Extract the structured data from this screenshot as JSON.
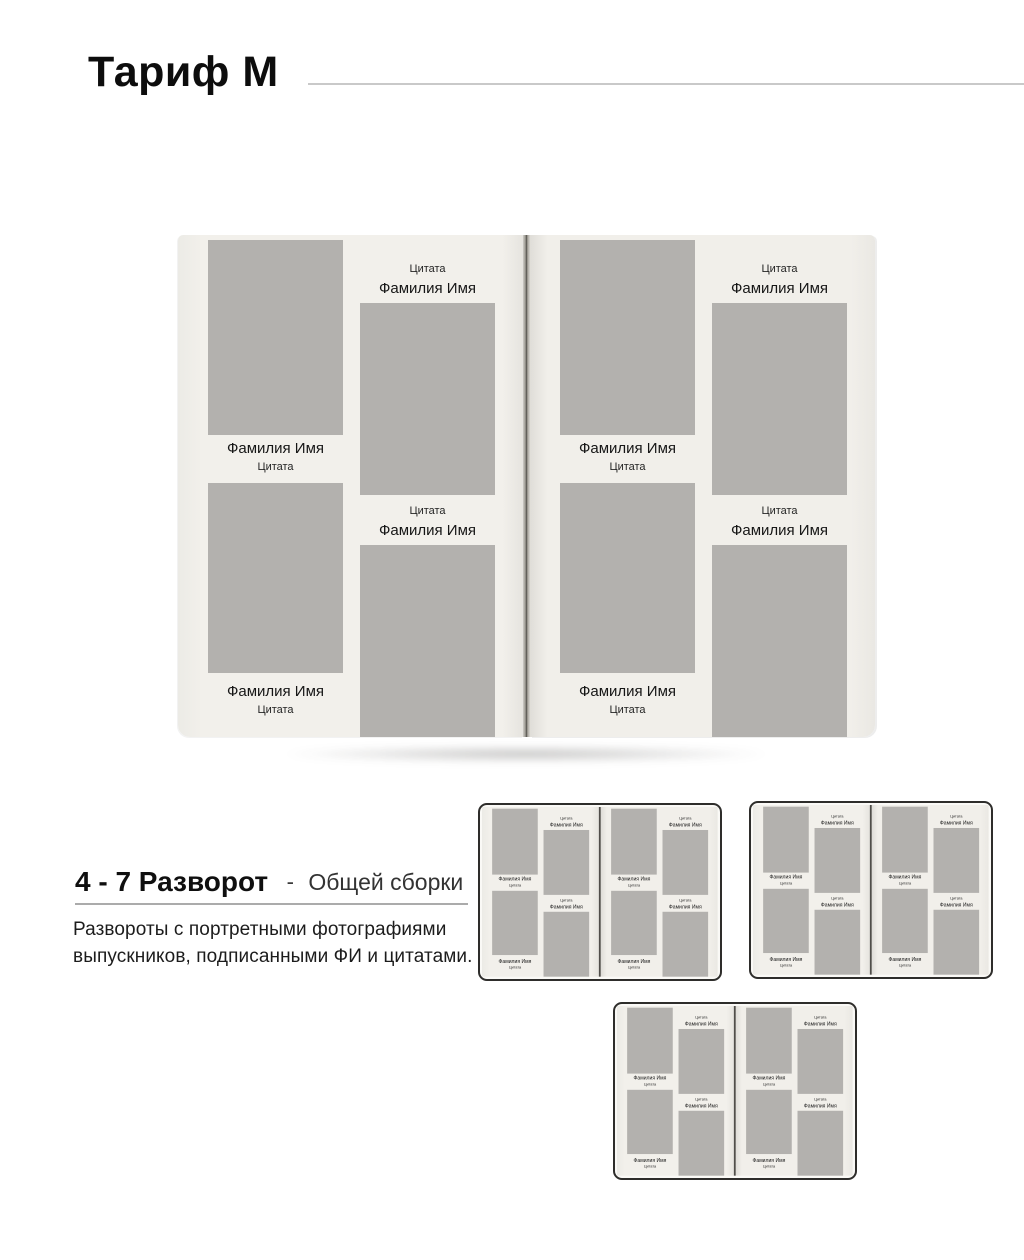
{
  "header": {
    "title": "Тариф М"
  },
  "section": {
    "heading_bold": "4 - 7 Разворот",
    "heading_dash": "-",
    "heading_light": "Общей сборки",
    "description_lines": [
      "Развороты с портретными фотографиями",
      "выпускников, подписанными ФИ и цитатами."
    ]
  },
  "book": {
    "name_label": "Фамилия Имя",
    "quote_label": "Цитата"
  },
  "mockups": {
    "large_spread_count": 1,
    "small_spread_count": 3,
    "photos_per_page": 4
  },
  "colors": {
    "page": "#f1efea",
    "photo": "#b3b1ae",
    "cover": "#2e2d2b",
    "rule": "#c9c9c9",
    "ink": "#111111"
  }
}
